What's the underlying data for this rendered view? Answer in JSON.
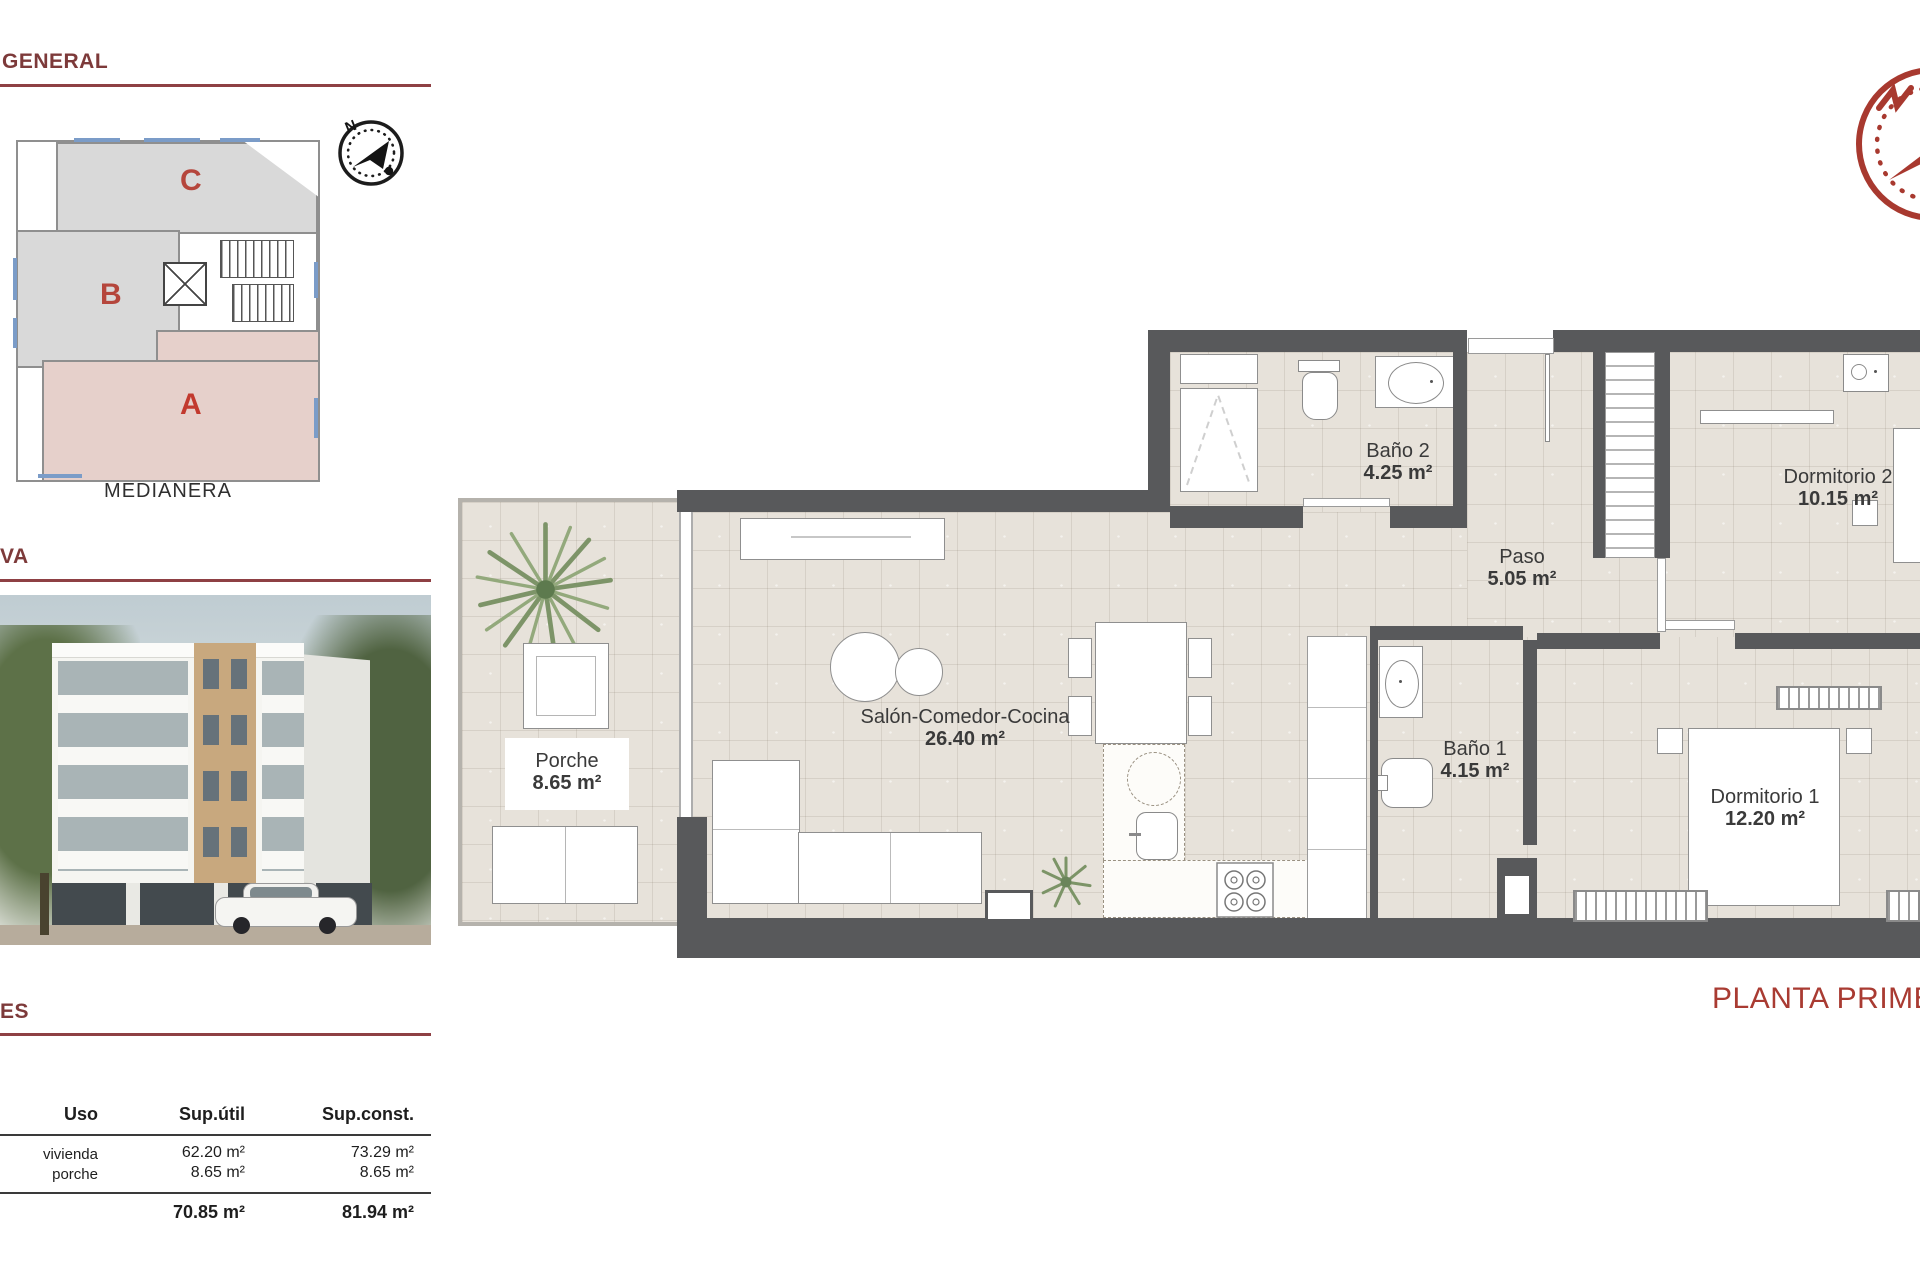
{
  "panel": {
    "heading_general": "GENERAL",
    "heading_va": "VA",
    "heading_es": "ES",
    "site_plan": {
      "unit_c": "C",
      "unit_b": "B",
      "unit_a": "A",
      "medianera": "MEDIANERA",
      "north": "N"
    },
    "table": {
      "headers": [
        "Uso",
        "Sup.útil",
        "Sup.const."
      ],
      "rows": [
        {
          "uso": "vivienda",
          "util": "62.20 m²",
          "const": "73.29 m²"
        },
        {
          "uso": "porche",
          "util": "8.65 m²",
          "const": "8.65 m²"
        }
      ],
      "total_util": "70.85 m²",
      "total_const": "81.94 m²"
    }
  },
  "plan": {
    "title": "PLANTA PRIME",
    "north": "N",
    "rooms": {
      "porche": {
        "name": "Porche",
        "area": "8.65 m²"
      },
      "salon": {
        "name": "Salón-Comedor-Cocina",
        "area": "26.40 m²"
      },
      "bano2": {
        "name": "Baño 2",
        "area": "4.25 m²"
      },
      "paso": {
        "name": "Paso",
        "area": "5.05 m²"
      },
      "dormitorio2": {
        "name": "Dormitorio 2",
        "area": "10.15 m²"
      },
      "bano1": {
        "name": "Baño 1",
        "area": "4.15 m²"
      },
      "dormitorio1": {
        "name": "Dormitorio 1",
        "area": "12.20 m²"
      }
    }
  },
  "colors": {
    "accent_maroon": "#8e4044",
    "planta_red": "#a93b32",
    "wall_gray": "#58595b",
    "floor_beige": "#e7e2da",
    "unit_fill_gray": "#d9d9d9",
    "unit_a_pink": "#e6d0cb",
    "unit_letter_red": "#b5463c",
    "window_blue": "#7b9cc8"
  }
}
